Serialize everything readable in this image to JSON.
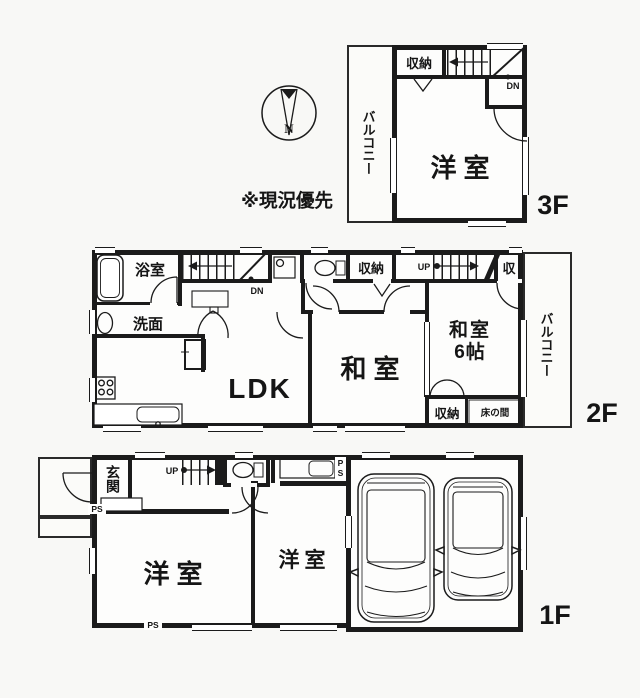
{
  "note_text": "※現況優先",
  "compass": {
    "north_label": "N"
  },
  "colors": {
    "line": "#1b1b1b",
    "paper": "#f8f8f6"
  },
  "floor3": {
    "floor_label": "3F",
    "balcony": "バルコニー",
    "storage": "収納",
    "down": "DN",
    "western_room": "洋室"
  },
  "floor2": {
    "floor_label": "2F",
    "bathroom": "浴室",
    "washroom": "洗面",
    "down": "DN",
    "up": "UP",
    "storage_top": "収納",
    "storage_small": "収",
    "ldk": "LDK",
    "japanese_room": "和室",
    "japanese_room6_line1": "和室",
    "japanese_room6_line2": "6帖",
    "storage_bottom": "収納",
    "tokonoma": "床の間",
    "balcony": "バルコニー"
  },
  "floor1": {
    "floor_label": "1F",
    "entrance": "玄関",
    "up": "UP",
    "ps": "PS",
    "western_room_large": "洋室",
    "western_room_small": "洋室"
  }
}
